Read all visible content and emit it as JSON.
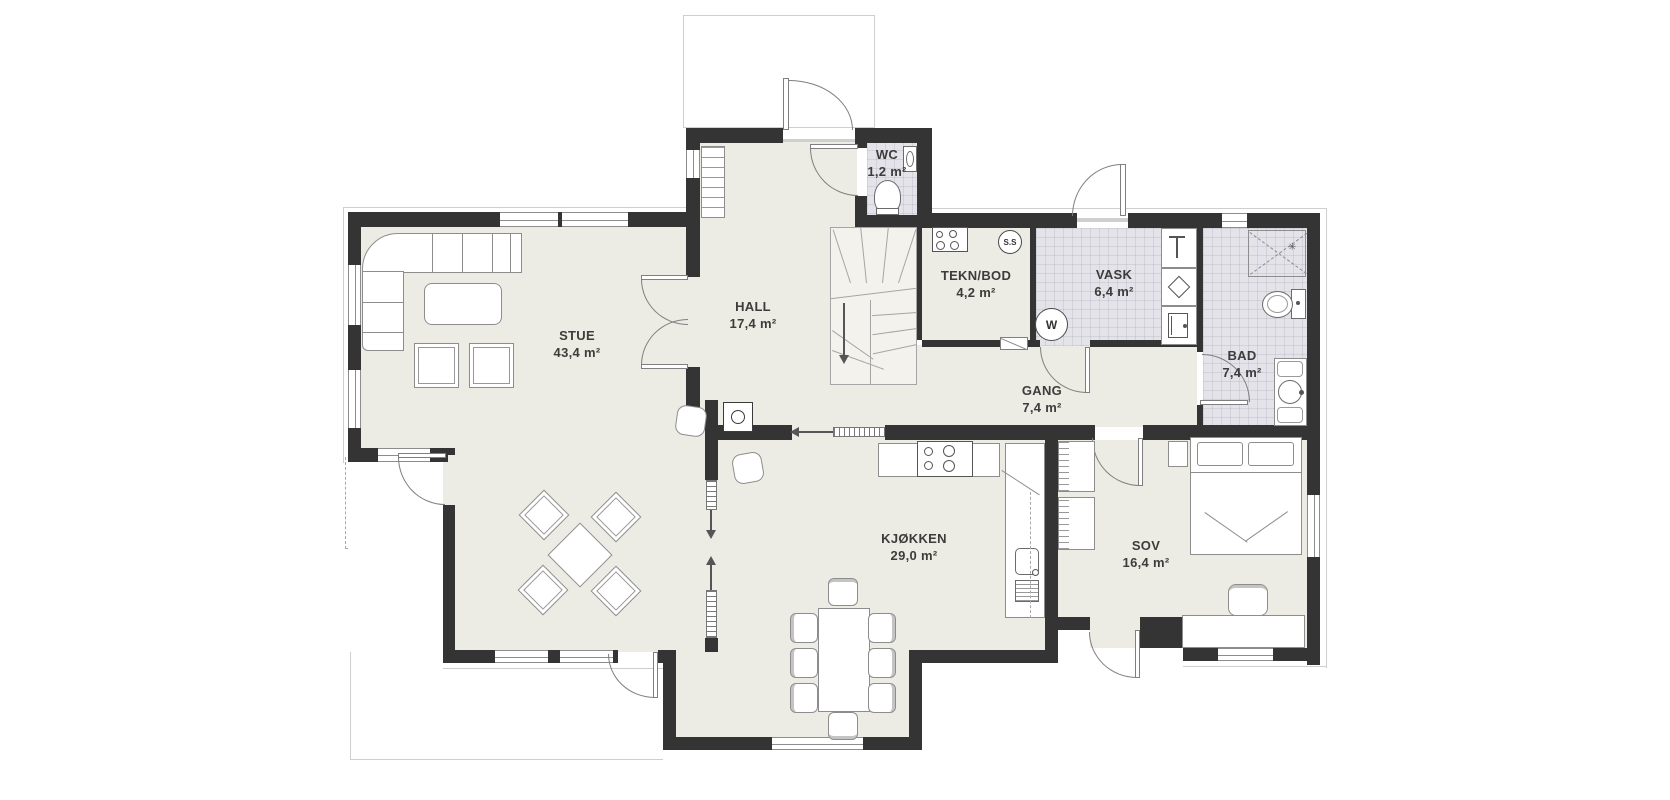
{
  "plan": {
    "rooms": [
      {
        "id": "stue",
        "name": "STUE",
        "area": "43,4 m²"
      },
      {
        "id": "hall",
        "name": "HALL",
        "area": "17,4 m²"
      },
      {
        "id": "wc",
        "name": "WC",
        "area": "1,2 m²"
      },
      {
        "id": "tekn_bod",
        "name": "TEKN/BOD",
        "area": "4,2 m²"
      },
      {
        "id": "vask",
        "name": "VASK",
        "area": "6,4 m²"
      },
      {
        "id": "gang",
        "name": "GANG",
        "area": "7,4 m²"
      },
      {
        "id": "bad",
        "name": "BAD",
        "area": "7,4 m²"
      },
      {
        "id": "kjokken",
        "name": "KJØKKEN",
        "area": "29,0 m²"
      },
      {
        "id": "sov",
        "name": "SOV",
        "area": "16,4 m²"
      }
    ],
    "symbols": {
      "washing_machine": "W",
      "ss_marker": "S.S"
    },
    "colors": {
      "wall": "#343434",
      "floor": "#edece4",
      "wet_floor": "#e3e3e9",
      "line": "#8d8d8d"
    }
  }
}
